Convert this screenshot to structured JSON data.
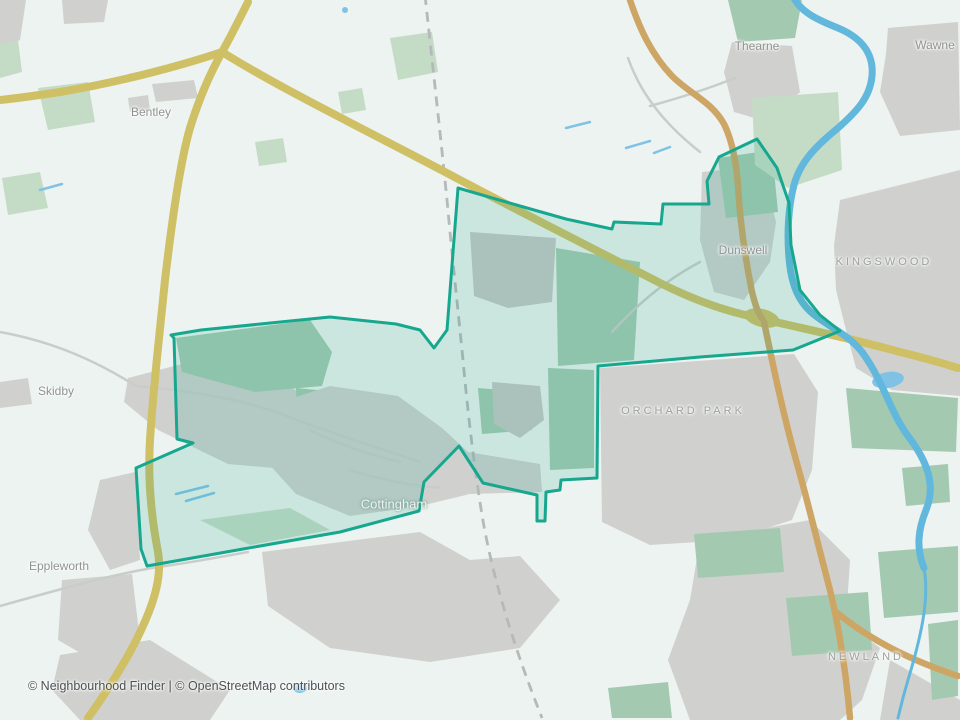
{
  "map": {
    "attribution": "© Neighbourhood Finder | © OpenStreetMap contributors",
    "labels": [
      {
        "id": "bentley",
        "text": "Bentley",
        "kind": "village"
      },
      {
        "id": "thearne",
        "text": "Thearne",
        "kind": "village"
      },
      {
        "id": "wawne",
        "text": "Wawne",
        "kind": "village"
      },
      {
        "id": "kingswood",
        "text": "KINGSWOOD",
        "kind": "district"
      },
      {
        "id": "dunswell",
        "text": "Dunswell",
        "kind": "village"
      },
      {
        "id": "orchard-park",
        "text": "ORCHARD PARK",
        "kind": "district"
      },
      {
        "id": "skidby",
        "text": "Skidby",
        "kind": "village"
      },
      {
        "id": "eppleworth",
        "text": "Eppleworth",
        "kind": "village"
      },
      {
        "id": "cottingham",
        "text": "Cottingham",
        "kind": "town"
      },
      {
        "id": "newland",
        "text": "NEWLAND",
        "kind": "district"
      }
    ],
    "highlighted_area": "Cottingham ward boundary",
    "palette": {
      "background": "#edf3f0",
      "urban_gray": "#d0d1ce",
      "urban_gray_dark": "#c6c8c4",
      "woodland_green": "#c4dcc6",
      "field_green": "#a3cab1",
      "boundary_teal": "#17a78e",
      "boundary_fill_rgba": "rgba(35,167,141,0.17)",
      "road_yellow": "#cfc066",
      "road_tan": "#cda666",
      "river_blue": "#62b7dc",
      "stream_blue": "#7fc2e6",
      "railway_gray": "#b4b9b9",
      "minor_road_gray": "#c9cdca",
      "label_gray": "#8f9492",
      "district_label_gray": "#9ba19e",
      "town_label_light": "#eef4f1",
      "attribution_text": "#4b5155"
    }
  }
}
